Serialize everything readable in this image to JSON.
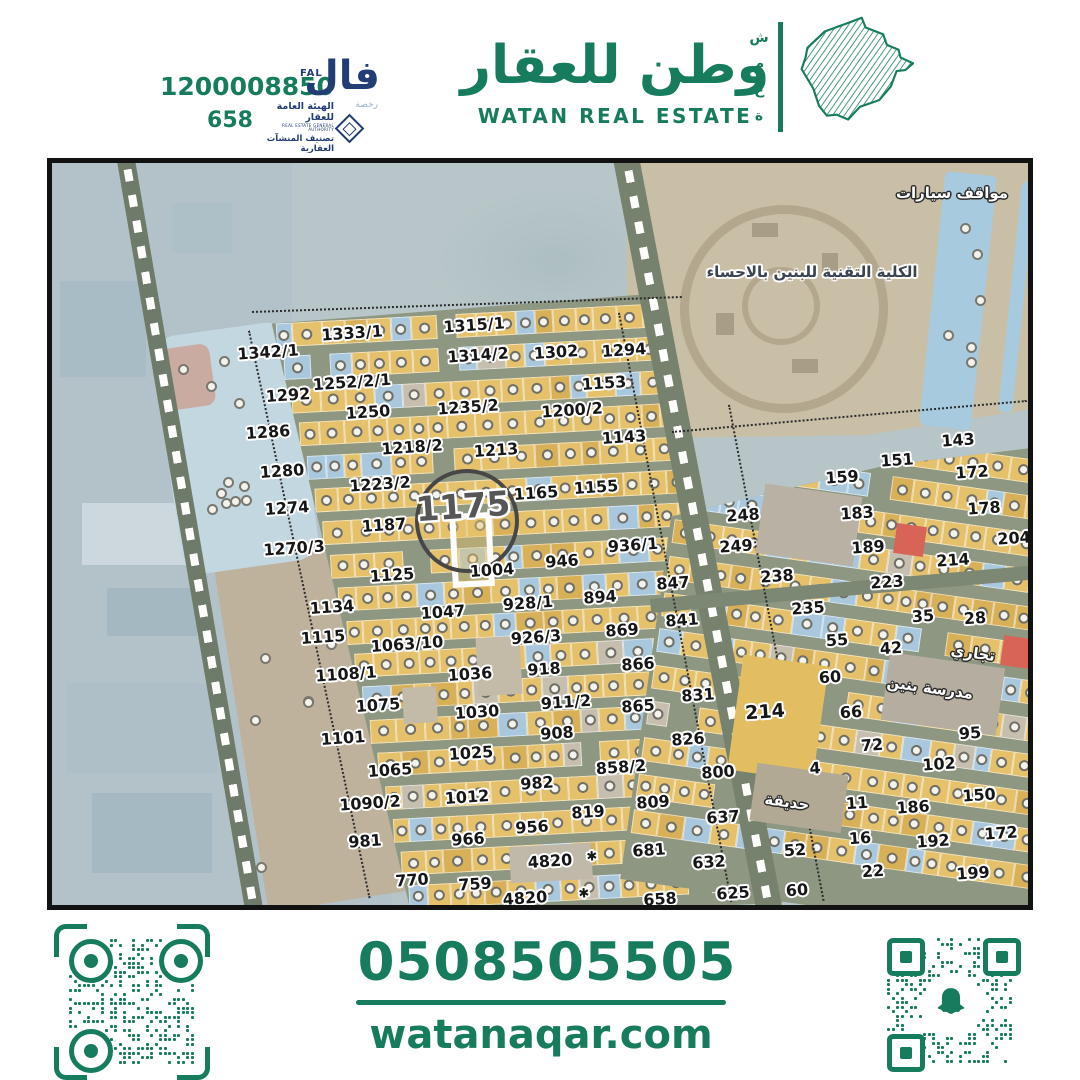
{
  "header": {
    "ad_number": "1200008850",
    "license_number": "658",
    "fal": {
      "en": "FAL",
      "arabic": "فال",
      "sub": "رخصة"
    },
    "authority": {
      "line1": "الهيئة العامة للعقار",
      "line2": "REAL ESTATE GENERAL AUTHORITY",
      "line3": "تصنيف المنشآت العقارية"
    },
    "brand": {
      "arabic": "وطن للعقار",
      "english": "WATAN REAL ESTATE",
      "vertical": "شمعة"
    }
  },
  "footer": {
    "phone": "0508505505",
    "website": "watanaqar.com"
  },
  "colors": {
    "brand_green": "#177B5E",
    "navy": "#223C74",
    "parcel_yellow": "#e5c16b",
    "parcel_blue": "#a9c8dd"
  },
  "map": {
    "highlight_parcel": "1175",
    "labels": [
      {
        "t": "1342/1",
        "x": 216,
        "y": 189
      },
      {
        "t": "1333/1",
        "x": 300,
        "y": 170
      },
      {
        "t": "1315/1",
        "x": 422,
        "y": 162
      },
      {
        "t": "1314/2",
        "x": 426,
        "y": 192
      },
      {
        "t": "1302",
        "x": 504,
        "y": 189
      },
      {
        "t": "1294",
        "x": 572,
        "y": 187
      },
      {
        "t": "1252/2/1",
        "x": 300,
        "y": 219
      },
      {
        "t": "1153",
        "x": 552,
        "y": 220
      },
      {
        "t": "1292",
        "x": 236,
        "y": 232
      },
      {
        "t": "1250",
        "x": 316,
        "y": 249
      },
      {
        "t": "1235/2",
        "x": 416,
        "y": 244
      },
      {
        "t": "1200/2",
        "x": 520,
        "y": 247
      },
      {
        "t": "1286",
        "x": 216,
        "y": 269
      },
      {
        "t": "1218/2",
        "x": 360,
        "y": 284
      },
      {
        "t": "1213",
        "x": 444,
        "y": 287
      },
      {
        "t": "1143",
        "x": 572,
        "y": 274
      },
      {
        "t": "1280",
        "x": 230,
        "y": 308
      },
      {
        "t": "1223/2",
        "x": 328,
        "y": 321
      },
      {
        "t": "1165",
        "x": 484,
        "y": 330
      },
      {
        "t": "1155",
        "x": 544,
        "y": 324
      },
      {
        "t": "1274",
        "x": 235,
        "y": 345
      },
      {
        "t": "1187",
        "x": 332,
        "y": 362
      },
      {
        "t": "1175",
        "x": 411,
        "y": 344,
        "c": "big"
      },
      {
        "t": "1270/3",
        "x": 242,
        "y": 385
      },
      {
        "t": "936/1",
        "x": 581,
        "y": 382
      },
      {
        "t": "946",
        "x": 510,
        "y": 398
      },
      {
        "t": "1004",
        "x": 440,
        "y": 407
      },
      {
        "t": "1125",
        "x": 340,
        "y": 412
      },
      {
        "t": "847",
        "x": 621,
        "y": 420
      },
      {
        "t": "1134",
        "x": 280,
        "y": 444
      },
      {
        "t": "1047",
        "x": 391,
        "y": 449
      },
      {
        "t": "928/1",
        "x": 476,
        "y": 440
      },
      {
        "t": "894",
        "x": 548,
        "y": 434
      },
      {
        "t": "841",
        "x": 630,
        "y": 457
      },
      {
        "t": "1115",
        "x": 271,
        "y": 474
      },
      {
        "t": "1063/10",
        "x": 355,
        "y": 481
      },
      {
        "t": "926/3",
        "x": 484,
        "y": 474
      },
      {
        "t": "869",
        "x": 570,
        "y": 467
      },
      {
        "t": "1108/1",
        "x": 294,
        "y": 511
      },
      {
        "t": "1036",
        "x": 418,
        "y": 511
      },
      {
        "t": "918",
        "x": 492,
        "y": 506
      },
      {
        "t": "866",
        "x": 586,
        "y": 501
      },
      {
        "t": "1075",
        "x": 326,
        "y": 542
      },
      {
        "t": "911/2",
        "x": 514,
        "y": 539
      },
      {
        "t": "865",
        "x": 586,
        "y": 543
      },
      {
        "t": "831",
        "x": 646,
        "y": 532
      },
      {
        "t": "1030",
        "x": 425,
        "y": 549
      },
      {
        "t": "1101",
        "x": 291,
        "y": 575
      },
      {
        "t": "908",
        "x": 505,
        "y": 570
      },
      {
        "t": "826",
        "x": 636,
        "y": 576
      },
      {
        "t": "1025",
        "x": 419,
        "y": 590
      },
      {
        "t": "858/2",
        "x": 569,
        "y": 604
      },
      {
        "t": "1065",
        "x": 338,
        "y": 607
      },
      {
        "t": "982",
        "x": 485,
        "y": 620
      },
      {
        "t": "800",
        "x": 666,
        "y": 609
      },
      {
        "t": "1090/2",
        "x": 318,
        "y": 640
      },
      {
        "t": "1012",
        "x": 415,
        "y": 634
      },
      {
        "t": "809",
        "x": 601,
        "y": 639
      },
      {
        "t": "819",
        "x": 536,
        "y": 649
      },
      {
        "t": "637",
        "x": 671,
        "y": 654
      },
      {
        "t": "981",
        "x": 313,
        "y": 678
      },
      {
        "t": "966",
        "x": 416,
        "y": 676
      },
      {
        "t": "956",
        "x": 480,
        "y": 664
      },
      {
        "t": "4820",
        "x": 498,
        "y": 698
      },
      {
        "t": "✱",
        "x": 540,
        "y": 694,
        "s": 13
      },
      {
        "t": "681",
        "x": 597,
        "y": 687
      },
      {
        "t": "770",
        "x": 360,
        "y": 717
      },
      {
        "t": "759",
        "x": 423,
        "y": 721
      },
      {
        "t": "632",
        "x": 657,
        "y": 699
      },
      {
        "t": "4820",
        "x": 473,
        "y": 735
      },
      {
        "t": "✱",
        "x": 532,
        "y": 731,
        "s": 13
      },
      {
        "t": "658",
        "x": 608,
        "y": 736
      },
      {
        "t": "625",
        "x": 681,
        "y": 730
      },
      {
        "t": "60",
        "x": 745,
        "y": 727
      },
      {
        "t": "248",
        "x": 691,
        "y": 352
      },
      {
        "t": "249",
        "x": 684,
        "y": 383
      },
      {
        "t": "238",
        "x": 725,
        "y": 413
      },
      {
        "t": "235",
        "x": 756,
        "y": 445
      },
      {
        "t": "143",
        "x": 906,
        "y": 277
      },
      {
        "t": "151",
        "x": 845,
        "y": 297
      },
      {
        "t": "159",
        "x": 790,
        "y": 314
      },
      {
        "t": "172",
        "x": 920,
        "y": 309
      },
      {
        "t": "178",
        "x": 932,
        "y": 345
      },
      {
        "t": "183",
        "x": 805,
        "y": 350
      },
      {
        "t": "189",
        "x": 816,
        "y": 384
      },
      {
        "t": "204",
        "x": 962,
        "y": 375
      },
      {
        "t": "214",
        "x": 901,
        "y": 397
      },
      {
        "t": "223",
        "x": 835,
        "y": 419
      },
      {
        "t": "35",
        "x": 871,
        "y": 453
      },
      {
        "t": "28",
        "x": 923,
        "y": 455
      },
      {
        "t": "55",
        "x": 785,
        "y": 477
      },
      {
        "t": "42",
        "x": 839,
        "y": 485
      },
      {
        "t": "60",
        "x": 778,
        "y": 514
      },
      {
        "t": "66",
        "x": 799,
        "y": 549
      },
      {
        "t": "95",
        "x": 918,
        "y": 570
      },
      {
        "t": "72",
        "x": 820,
        "y": 582
      },
      {
        "t": "102",
        "x": 887,
        "y": 601
      },
      {
        "t": "4",
        "x": 763,
        "y": 605
      },
      {
        "t": "214",
        "x": 713,
        "y": 549,
        "s": 19
      },
      {
        "t": "150",
        "x": 927,
        "y": 632
      },
      {
        "t": "11",
        "x": 805,
        "y": 640
      },
      {
        "t": "186",
        "x": 861,
        "y": 644
      },
      {
        "t": "16",
        "x": 808,
        "y": 675
      },
      {
        "t": "192",
        "x": 881,
        "y": 678
      },
      {
        "t": "172",
        "x": 949,
        "y": 670
      },
      {
        "t": "52",
        "x": 743,
        "y": 687
      },
      {
        "t": "22",
        "x": 821,
        "y": 708
      },
      {
        "t": "199",
        "x": 921,
        "y": 710
      },
      {
        "t": "مواقف سيارات",
        "x": 900,
        "y": 30,
        "c": "w"
      },
      {
        "t": "الكلية التقنية للبنين بالاحساء",
        "x": 760,
        "y": 109,
        "c": "c"
      },
      {
        "t": "تجاري",
        "x": 921,
        "y": 490,
        "c": "w",
        "r": 8
      },
      {
        "t": "مدرسة بنين",
        "x": 878,
        "y": 525,
        "c": "w",
        "r": 8
      },
      {
        "t": "حديقة",
        "x": 735,
        "y": 639,
        "c": "w",
        "r": 8
      }
    ]
  }
}
